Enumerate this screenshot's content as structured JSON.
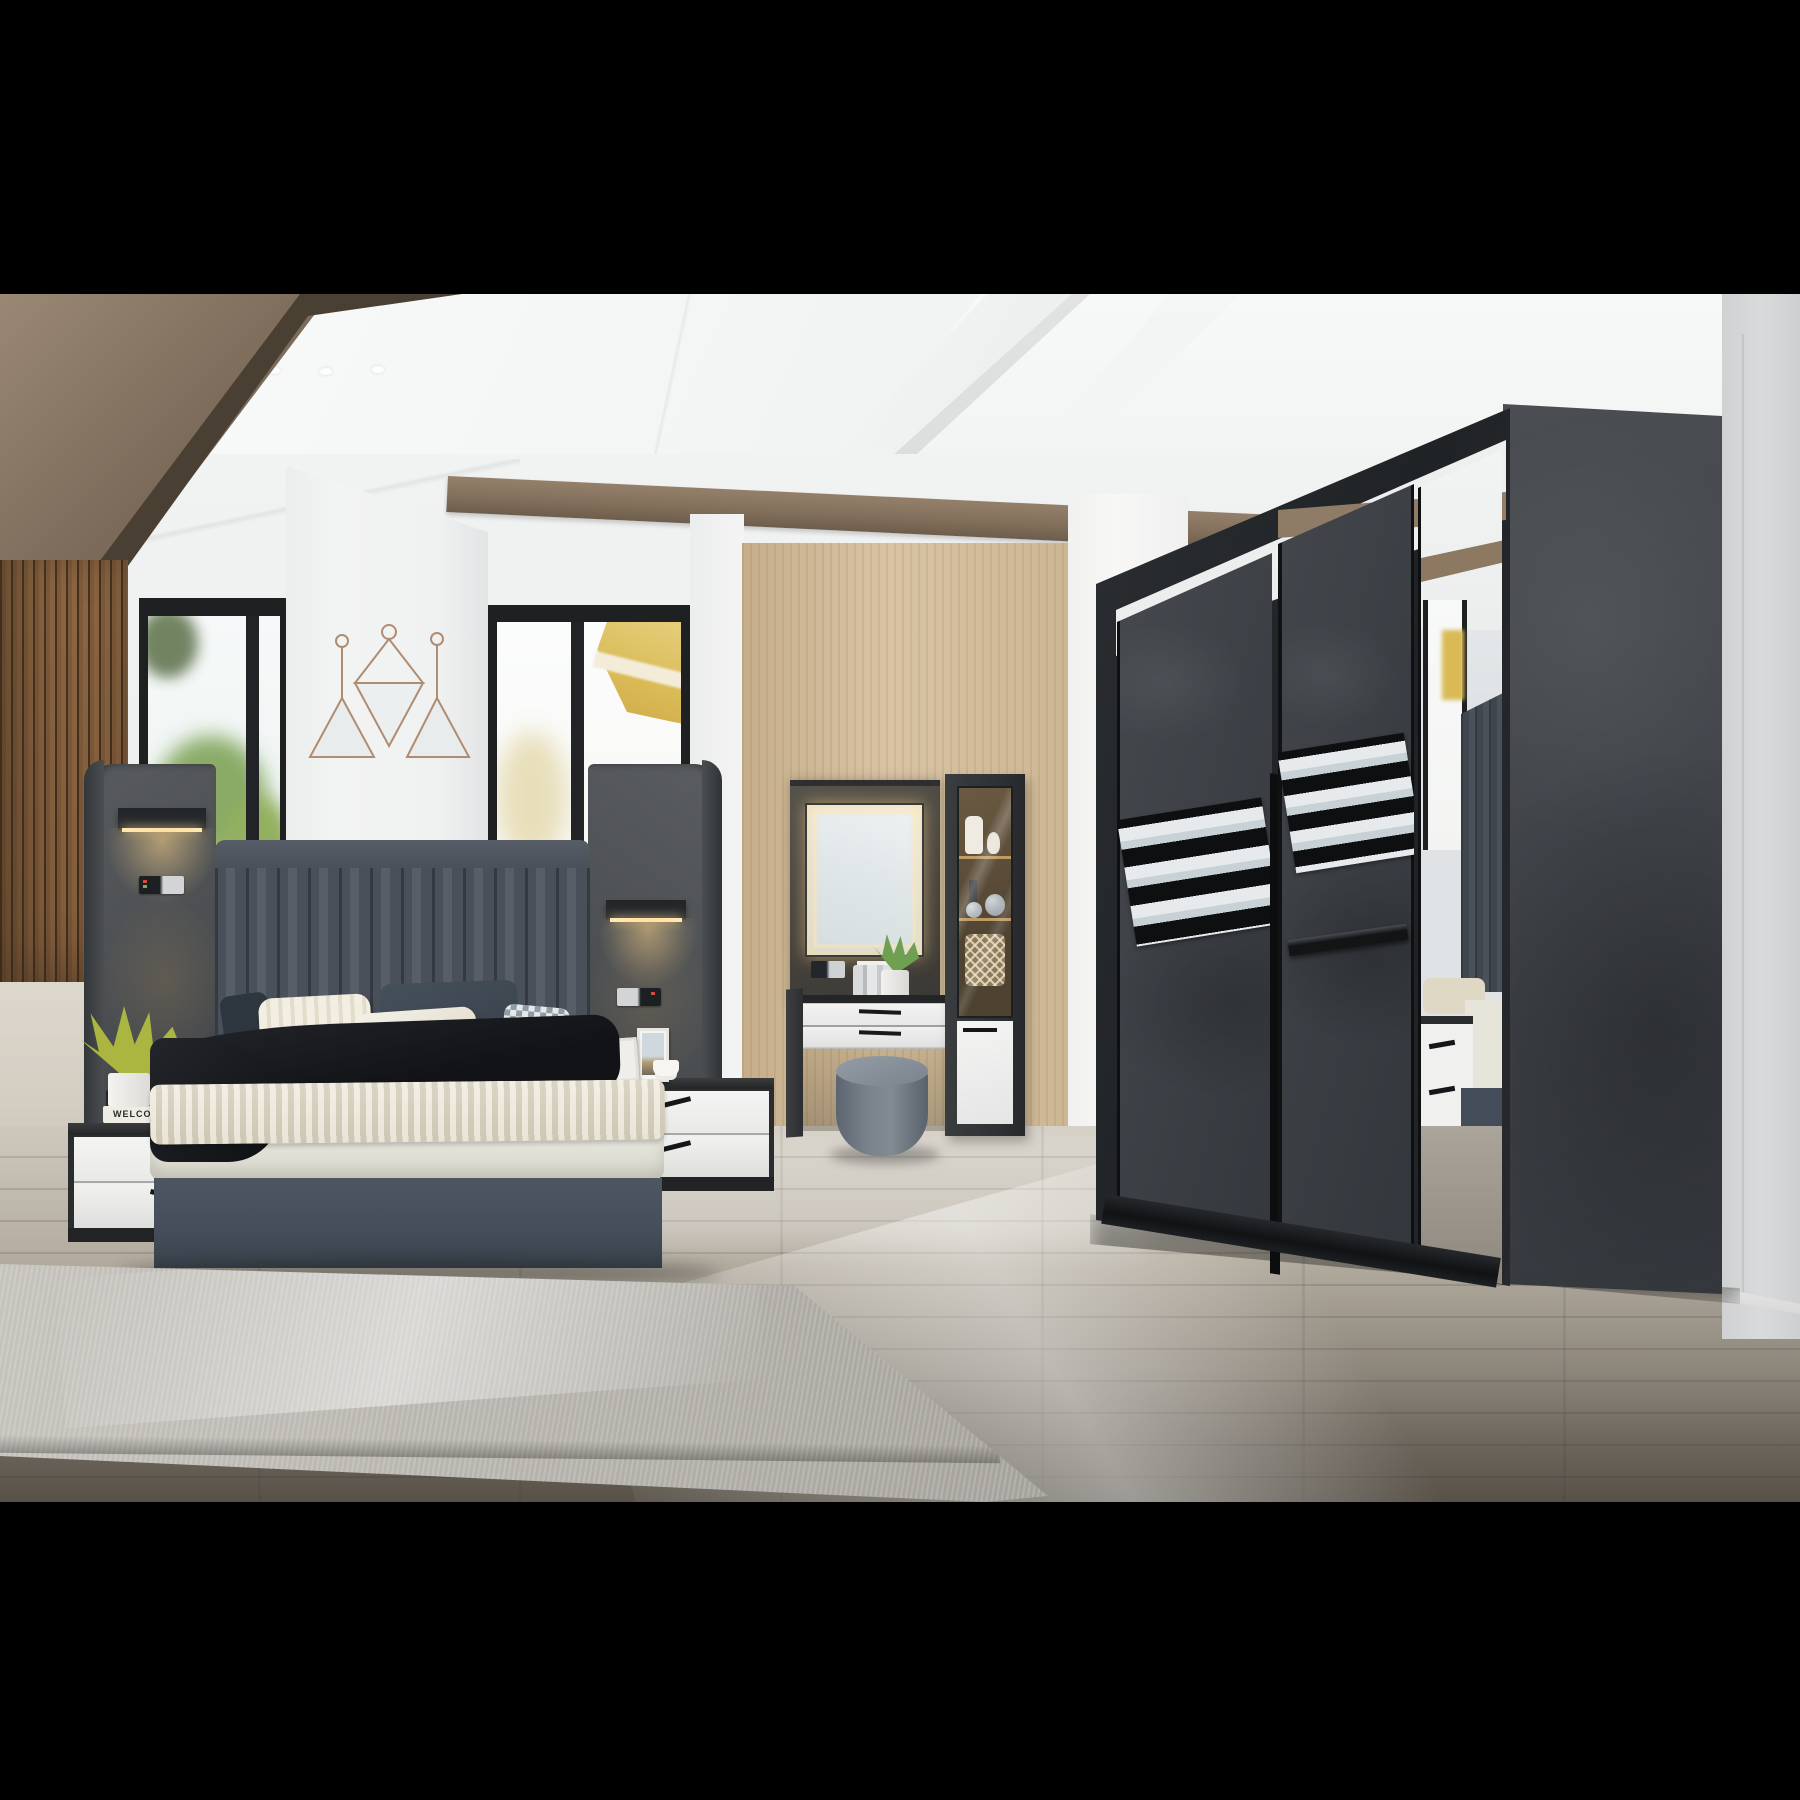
{
  "image": {
    "type": "interior-photograph",
    "subject": "Modern bedroom furniture set: upholstered bed with winged headboard and reading lights, white nightstands, backlit dressing table with display cabinet and stool, large charcoal sliding-door wardrobe with mirror panel",
    "letterbox_color": "#000000"
  },
  "text": {
    "book_spine_bottom": "WELCOME"
  },
  "palette": {
    "ceiling": "#f6f7f7",
    "wall": "#eff1f1",
    "right_wall": "#d6d8da",
    "wood_slats": "#b79c7d",
    "soffit_wood": "#7b6a59",
    "oak_panel": "#d3bd9b",
    "ceiling_beam_wood": "#8a7560",
    "window_frame": "#1e2022",
    "foliage_green": "#8fae5e",
    "building_yellow": "#d9ba55",
    "headboard_leather": "#49505a",
    "wing_panel": "#4f5254",
    "lamp_glow": "#ffd98c",
    "bedding_ivory": "#e9e8df",
    "knit_throw": "#e4decf",
    "throw_black": "#17181a",
    "bed_base": "#46505b",
    "nightstand_white": "#f1f1ef",
    "dark_trim": "#26282a",
    "vanity_panel": "#4a4843",
    "stool_gray": "#76808a",
    "wardrobe_door": "#3e4246",
    "wardrobe_side": "#45494d",
    "gloss_black": "#17191c",
    "mirror": "#e3e8e9",
    "copper_frame": "#b08d72",
    "floor_light": "#cfc9bd",
    "floor_dark": "#5e5850",
    "rug": "#b7b4ae"
  },
  "objects": {
    "decor": "three copper-wire triangle mirrors on column",
    "left_nightstand_items": "yellow-green plant in white pot on two books",
    "right_nightstand_items": "two photo frames and white coffee cup",
    "vanity_items": "LED backlit mirror, perfume bottles, potted plant",
    "cabinet_items": "white jug, vases, silver spheres, wire basket",
    "wardrobe": "two textured sliding doors with mirror strip bands plus full-height mirror door reflecting the bed"
  }
}
